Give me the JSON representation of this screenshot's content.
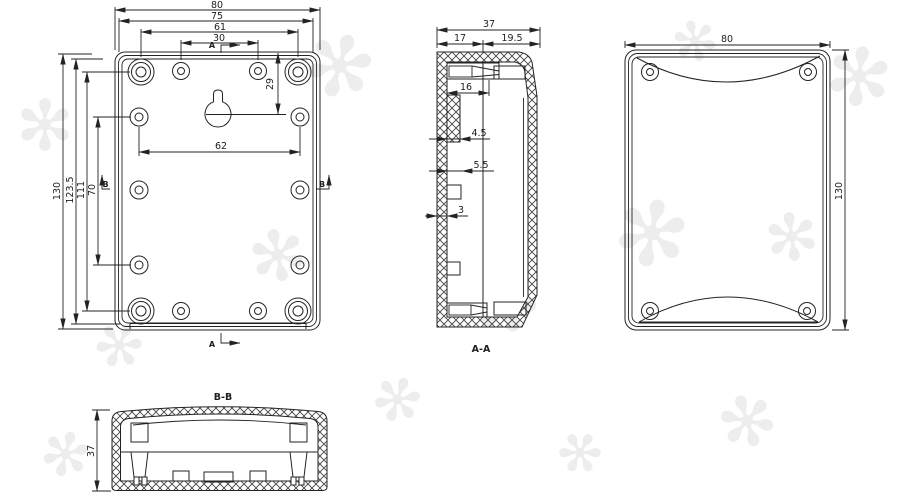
{
  "colors": {
    "line": "#232323",
    "background": "#ffffff",
    "watermark": "#e9e9e9"
  },
  "decor": {
    "watermark_glyph": "✻"
  },
  "front_view": {
    "top_dims": [
      "80",
      "75",
      "61",
      "30"
    ],
    "left_dims": [
      "130",
      "123.5",
      "111",
      "70"
    ],
    "dim_vertical_29": "29",
    "dim_width_62": "62",
    "marker_a_top": "A",
    "marker_a_bottom": "A",
    "marker_b_left": "B",
    "marker_b_right": "B"
  },
  "section_aa": {
    "label": "A-A",
    "dim_depth_37": "37",
    "dim_17": "17",
    "dim_19_5": "19.5",
    "dim_16": "16",
    "dim_4_5": "4.5",
    "dim_5_5": "5.5",
    "dim_wall_3": "3"
  },
  "side_view": {
    "dim_width_80": "80",
    "dim_height_130": "130"
  },
  "section_bb": {
    "label": "B-B",
    "dim_depth_37": "37"
  }
}
